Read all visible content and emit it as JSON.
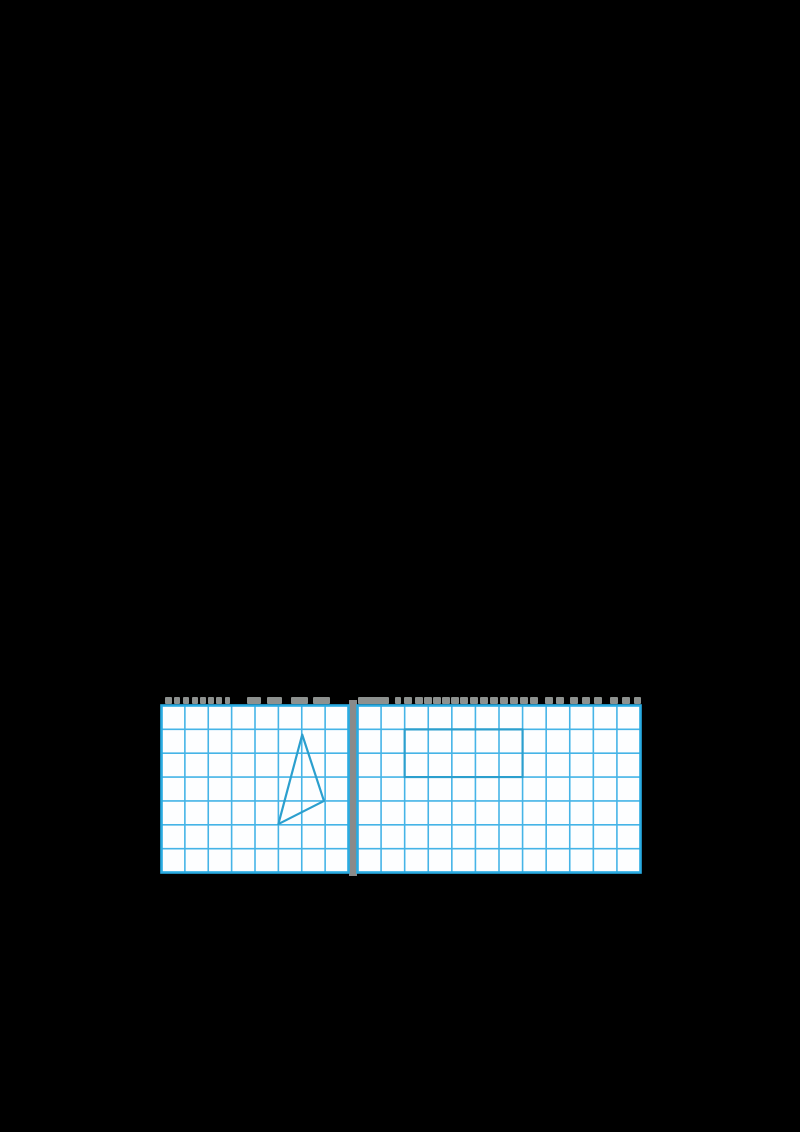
{
  "page": {
    "width": 800,
    "height": 1132,
    "background": "#000000"
  },
  "colors": {
    "grid_line": "#45b4e7",
    "grid_border": "#29abe2",
    "cell_fill": "#fdfeff",
    "shape_stroke": "#2b9fce",
    "divider": "#8a8a8a",
    "caption_fragment": "#8d918f"
  },
  "caption_strip": {
    "top": 697,
    "height": 7,
    "left_fragments": [
      [
        165,
        7
      ],
      [
        174,
        6
      ],
      [
        183,
        6
      ],
      [
        192,
        6
      ],
      [
        200,
        6
      ],
      [
        208,
        6
      ],
      [
        216,
        6
      ],
      [
        225,
        5
      ],
      [
        247,
        14
      ],
      [
        267,
        15
      ],
      [
        291,
        17
      ],
      [
        313,
        17
      ]
    ],
    "right_fragments": [
      [
        358,
        31
      ],
      [
        395,
        6
      ],
      [
        404,
        8
      ],
      [
        415,
        8
      ],
      [
        424,
        8
      ],
      [
        433,
        8
      ],
      [
        442,
        8
      ],
      [
        451,
        8
      ],
      [
        460,
        8
      ],
      [
        470,
        8
      ],
      [
        480,
        8
      ],
      [
        490,
        8
      ],
      [
        500,
        8
      ],
      [
        510,
        8
      ],
      [
        520,
        8
      ],
      [
        530,
        8
      ],
      [
        545,
        8
      ],
      [
        556,
        8
      ],
      [
        570,
        8
      ],
      [
        582,
        8
      ],
      [
        594,
        8
      ],
      [
        610,
        8
      ],
      [
        622,
        8
      ],
      [
        634,
        7
      ]
    ]
  },
  "divider": {
    "left": 348.5,
    "top": 700,
    "width": 8.5,
    "height": 176
  },
  "grids": [
    {
      "id": "left-practice-grid",
      "left": 161,
      "top": 705,
      "width": 187,
      "height": 167,
      "cols": 8,
      "rows": 7,
      "shape": {
        "type": "polygon",
        "name": "triangle-figure",
        "points_cells": [
          [
            6.02,
            1.22
          ],
          [
            6.95,
            4.0
          ],
          [
            5.0,
            4.97
          ]
        ]
      }
    },
    {
      "id": "right-practice-grid",
      "left": 357,
      "top": 705,
      "width": 283,
      "height": 167,
      "cols": 12,
      "rows": 7,
      "shape": {
        "type": "polygon",
        "name": "rectangle-figure",
        "points_cells": [
          [
            2,
            1
          ],
          [
            7,
            1
          ],
          [
            7,
            3
          ],
          [
            2,
            3
          ]
        ]
      }
    }
  ]
}
